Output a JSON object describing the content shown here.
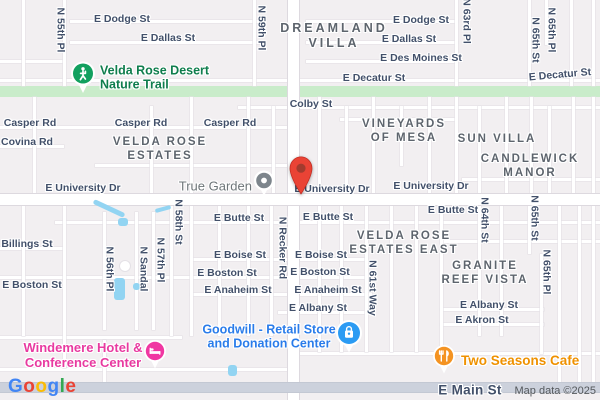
{
  "footer": {
    "attribution": "Map data ©2025",
    "google_letters": [
      "G",
      "o",
      "o",
      "g",
      "l",
      "e"
    ],
    "google_colors": [
      "#4285F4",
      "#EA4335",
      "#FBBC05",
      "#4285F4",
      "#34A853",
      "#EA4335"
    ]
  },
  "colors": {
    "background": "#f2eff1",
    "trail_band": "#c9ecca",
    "street_text": "#42506a",
    "area_text": "#5d646d",
    "trail_green": "#0f7d4d",
    "trail_pin": "#12a05f",
    "generic_pin_gray": "#7d858c",
    "generic_text_gray": "#6e7579",
    "shop_blue": "#2b9bf3",
    "shop_text_blue": "#2a7cea",
    "hotel_pink": "#f037a2",
    "hotel_text_pink": "#e83aa0",
    "cafe_orange": "#f49322",
    "cafe_text_orange": "#ef9100",
    "dest_pin_red": "#ea4335",
    "dest_pin_inner": "#a33b2e",
    "water_blue": "#92d4f2",
    "arterial_road": "#ccd1dc"
  },
  "pois": {
    "trail": {
      "label": "Velda Rose Desert\nNature Trail"
    },
    "true_garden": {
      "label": "True Garden"
    },
    "goodwill": {
      "label": "Goodwill - Retail Store\nand Donation Center"
    },
    "windemere": {
      "label": "Windemere Hotel &\nConference Center"
    },
    "two_seasons": {
      "label": "Two Seasons Cafe"
    }
  },
  "map": {
    "trail_band": {
      "y": 86,
      "h": 11
    },
    "street_labels": [
      {
        "t": "E Dodge St",
        "x": 122,
        "y": 19
      },
      {
        "t": "E Dallas St",
        "x": 168,
        "y": 38
      },
      {
        "t": "E Dodge St",
        "x": 421,
        "y": 20
      },
      {
        "t": "E Dallas St",
        "x": 409,
        "y": 39
      },
      {
        "t": "E Des Moines St",
        "x": 421,
        "y": 58
      },
      {
        "t": "E Decatur St",
        "x": 374,
        "y": 78
      },
      {
        "t": "E Decatur St",
        "x": 560,
        "y": 75,
        "r": -5
      },
      {
        "t": "N 55th Pl",
        "x": 60,
        "y": 30,
        "v": 1
      },
      {
        "t": "N 59th Pl",
        "x": 261,
        "y": 28,
        "v": 1
      },
      {
        "t": "N 63rd Pl",
        "x": 466,
        "y": 21,
        "v": 1
      },
      {
        "t": "N 65th St",
        "x": 535,
        "y": 40,
        "v": 1
      },
      {
        "t": "N 65th Pl",
        "x": 551,
        "y": 30,
        "v": 1
      },
      {
        "t": "Colby St",
        "x": 311,
        "y": 104
      },
      {
        "t": "Casper Rd",
        "x": 30,
        "y": 123
      },
      {
        "t": "Casper Rd",
        "x": 141,
        "y": 123
      },
      {
        "t": "Casper Rd",
        "x": 230,
        "y": 123
      },
      {
        "t": "Covina Rd",
        "x": 27,
        "y": 142
      },
      {
        "t": "E University Dr",
        "x": 83,
        "y": 188
      },
      {
        "t": "E University Dr",
        "x": 332,
        "y": 189
      },
      {
        "t": "E University Dr",
        "x": 431,
        "y": 186
      },
      {
        "t": "E Butte St",
        "x": 239,
        "y": 218
      },
      {
        "t": "E Butte St",
        "x": 328,
        "y": 217
      },
      {
        "t": "E Butte St",
        "x": 453,
        "y": 210
      },
      {
        "t": "N Recker Rd",
        "x": 282,
        "y": 248,
        "v": 1
      },
      {
        "t": "Billings St",
        "x": 27,
        "y": 244
      },
      {
        "t": "E Boston St",
        "x": 32,
        "y": 285
      },
      {
        "t": "N 56th Pl",
        "x": 109,
        "y": 269,
        "v": 1
      },
      {
        "t": "N Sandal",
        "x": 143,
        "y": 269,
        "v": 1
      },
      {
        "t": "N 57th Pl",
        "x": 160,
        "y": 260,
        "v": 1
      },
      {
        "t": "N 58th St",
        "x": 178,
        "y": 222,
        "v": 1
      },
      {
        "t": "E Boise St",
        "x": 240,
        "y": 255
      },
      {
        "t": "E Boise St",
        "x": 321,
        "y": 255
      },
      {
        "t": "E Boston St",
        "x": 227,
        "y": 273
      },
      {
        "t": "E Boston St",
        "x": 320,
        "y": 272
      },
      {
        "t": "E Anaheim St",
        "x": 238,
        "y": 290
      },
      {
        "t": "E Anaheim St",
        "x": 328,
        "y": 290
      },
      {
        "t": "E Albany St",
        "x": 318,
        "y": 308
      },
      {
        "t": "N 61st Way",
        "x": 372,
        "y": 288,
        "v": 1
      },
      {
        "t": "N 64th St",
        "x": 484,
        "y": 220,
        "v": 1
      },
      {
        "t": "N 65th St",
        "x": 534,
        "y": 218,
        "v": 1
      },
      {
        "t": "N 65th Pl",
        "x": 546,
        "y": 272,
        "v": 1
      },
      {
        "t": "E Albany St",
        "x": 489,
        "y": 305
      },
      {
        "t": "E Akron St",
        "x": 482,
        "y": 320
      },
      {
        "t": "E Main St",
        "x": 470,
        "y": 390,
        "big": 1
      }
    ],
    "area_labels": [
      {
        "t": "DREAMLAND\nVILLA",
        "x": 334,
        "y": 36,
        "big": 1
      },
      {
        "t": "VELDA ROSE\nESTATES",
        "x": 160,
        "y": 150
      },
      {
        "t": "VINEYARDS\nOF MESA",
        "x": 404,
        "y": 132
      },
      {
        "t": "SUN VILLA",
        "x": 497,
        "y": 140
      },
      {
        "t": "CANDLEWICK\nMANOR",
        "x": 530,
        "y": 167
      },
      {
        "t": "VELDA ROSE\nESTATES EAST",
        "x": 404,
        "y": 244
      },
      {
        "t": "GRANITE\nREEF VISTA",
        "x": 485,
        "y": 274
      }
    ],
    "roads": [
      {
        "o": "h",
        "x": 70,
        "y": 20,
        "l": 192
      },
      {
        "o": "h",
        "x": 306,
        "y": 20,
        "l": 152
      },
      {
        "o": "h",
        "x": 70,
        "y": 41,
        "l": 192
      },
      {
        "o": "h",
        "x": 306,
        "y": 41,
        "l": 152
      },
      {
        "o": "h",
        "x": 0,
        "y": 60,
        "l": 64
      },
      {
        "o": "h",
        "x": 306,
        "y": 60,
        "l": 152
      },
      {
        "o": "h",
        "x": 0,
        "y": 79,
        "l": 600
      },
      {
        "o": "h",
        "x": 238,
        "y": 106,
        "l": 362
      },
      {
        "o": "h",
        "x": 0,
        "y": 126,
        "l": 294
      },
      {
        "o": "h",
        "x": 0,
        "y": 145,
        "l": 64
      },
      {
        "o": "h",
        "x": 95,
        "y": 164,
        "l": 199
      },
      {
        "o": "h",
        "x": 340,
        "y": 118,
        "l": 115
      },
      {
        "o": "h",
        "x": 462,
        "y": 178,
        "l": 138
      },
      {
        "o": "h",
        "x": 55,
        "y": 221,
        "l": 545
      },
      {
        "o": "h",
        "x": 0,
        "y": 247,
        "l": 64
      },
      {
        "o": "h",
        "x": 190,
        "y": 258,
        "l": 178
      },
      {
        "o": "h",
        "x": 440,
        "y": 240,
        "l": 160
      },
      {
        "o": "h",
        "x": 0,
        "y": 276,
        "l": 368
      },
      {
        "o": "h",
        "x": 190,
        "y": 293,
        "l": 182
      },
      {
        "o": "h",
        "x": 278,
        "y": 311,
        "l": 94
      },
      {
        "o": "h",
        "x": 440,
        "y": 308,
        "l": 104
      },
      {
        "o": "h",
        "x": 440,
        "y": 323,
        "l": 104
      },
      {
        "o": "h",
        "x": 0,
        "y": 336,
        "l": 182
      },
      {
        "o": "h",
        "x": 300,
        "y": 352,
        "l": 300
      },
      {
        "o": "h",
        "x": 0,
        "y": 368,
        "l": 290
      },
      {
        "o": "v",
        "x": 22,
        "y": 0,
        "l": 86
      },
      {
        "o": "v",
        "x": 63,
        "y": 0,
        "l": 86
      },
      {
        "o": "v",
        "x": 253,
        "y": 0,
        "l": 86
      },
      {
        "o": "v",
        "x": 455,
        "y": 0,
        "l": 86
      },
      {
        "o": "v",
        "x": 528,
        "y": 0,
        "l": 86
      },
      {
        "o": "v",
        "x": 545,
        "y": 0,
        "l": 45
      },
      {
        "o": "v",
        "x": 570,
        "y": 0,
        "l": 86
      },
      {
        "o": "v",
        "x": 592,
        "y": 0,
        "l": 86
      },
      {
        "o": "v",
        "x": 33,
        "y": 97,
        "l": 97
      },
      {
        "o": "v",
        "x": 150,
        "y": 106,
        "l": 88
      },
      {
        "o": "v",
        "x": 190,
        "y": 97,
        "l": 97
      },
      {
        "o": "v",
        "x": 247,
        "y": 97,
        "l": 97
      },
      {
        "o": "v",
        "x": 272,
        "y": 106,
        "l": 88
      },
      {
        "o": "v",
        "x": 318,
        "y": 97,
        "l": 97
      },
      {
        "o": "v",
        "x": 345,
        "y": 106,
        "l": 88
      },
      {
        "o": "v",
        "x": 372,
        "y": 97,
        "l": 97
      },
      {
        "o": "v",
        "x": 400,
        "y": 106,
        "l": 60
      },
      {
        "o": "v",
        "x": 428,
        "y": 97,
        "l": 97
      },
      {
        "o": "v",
        "x": 455,
        "y": 97,
        "l": 97
      },
      {
        "o": "v",
        "x": 478,
        "y": 106,
        "l": 88
      },
      {
        "o": "v",
        "x": 505,
        "y": 97,
        "l": 97
      },
      {
        "o": "v",
        "x": 530,
        "y": 97,
        "l": 97
      },
      {
        "o": "v",
        "x": 548,
        "y": 106,
        "l": 88
      },
      {
        "o": "v",
        "x": 572,
        "y": 97,
        "l": 97
      },
      {
        "o": "v",
        "x": 592,
        "y": 97,
        "l": 97
      },
      {
        "o": "v",
        "x": 22,
        "y": 204,
        "l": 132
      },
      {
        "o": "v",
        "x": 63,
        "y": 204,
        "l": 164
      },
      {
        "o": "v",
        "x": 103,
        "y": 212,
        "l": 118
      },
      {
        "o": "v",
        "x": 135,
        "y": 212,
        "l": 118
      },
      {
        "o": "v",
        "x": 152,
        "y": 212,
        "l": 118
      },
      {
        "o": "v",
        "x": 170,
        "y": 204,
        "l": 132
      },
      {
        "o": "v",
        "x": 190,
        "y": 204,
        "l": 132
      },
      {
        "o": "v",
        "x": 218,
        "y": 204,
        "l": 132
      },
      {
        "o": "v",
        "x": 247,
        "y": 204,
        "l": 132
      },
      {
        "o": "v",
        "x": 270,
        "y": 204,
        "l": 132
      },
      {
        "o": "v",
        "x": 318,
        "y": 204,
        "l": 148
      },
      {
        "o": "v",
        "x": 340,
        "y": 204,
        "l": 148
      },
      {
        "o": "v",
        "x": 365,
        "y": 204,
        "l": 148
      },
      {
        "o": "v",
        "x": 390,
        "y": 204,
        "l": 148
      },
      {
        "o": "v",
        "x": 415,
        "y": 204,
        "l": 148
      },
      {
        "o": "v",
        "x": 440,
        "y": 204,
        "l": 148
      },
      {
        "o": "v",
        "x": 478,
        "y": 204,
        "l": 132
      },
      {
        "o": "v",
        "x": 500,
        "y": 204,
        "l": 132
      },
      {
        "o": "v",
        "x": 528,
        "y": 204,
        "l": 50
      },
      {
        "o": "v",
        "x": 540,
        "y": 254,
        "l": 100
      },
      {
        "o": "v",
        "x": 558,
        "y": 204,
        "l": 180
      },
      {
        "o": "v",
        "x": 578,
        "y": 204,
        "l": 180
      },
      {
        "o": "v",
        "x": 592,
        "y": 204,
        "l": 180
      },
      {
        "o": "v",
        "x": 103,
        "y": 340,
        "l": 44
      },
      {
        "o": "v",
        "x": 288,
        "y": 0,
        "l": 400,
        "c": "major"
      },
      {
        "o": "h",
        "x": 0,
        "y": 194,
        "l": 600,
        "c": "major"
      },
      {
        "o": "h",
        "x": 0,
        "y": 383,
        "l": 600,
        "c": "arterial"
      }
    ],
    "water": [
      {
        "x": 92,
        "y": 206,
        "w": 34,
        "h": 5,
        "r": 25
      },
      {
        "x": 118,
        "y": 218,
        "w": 10,
        "h": 8
      },
      {
        "x": 114,
        "y": 278,
        "w": 11,
        "h": 22
      },
      {
        "x": 133,
        "y": 283,
        "w": 7,
        "h": 7
      },
      {
        "x": 228,
        "y": 365,
        "w": 9,
        "h": 11
      },
      {
        "x": 155,
        "y": 207,
        "w": 16,
        "h": 4,
        "r": -15
      }
    ]
  }
}
